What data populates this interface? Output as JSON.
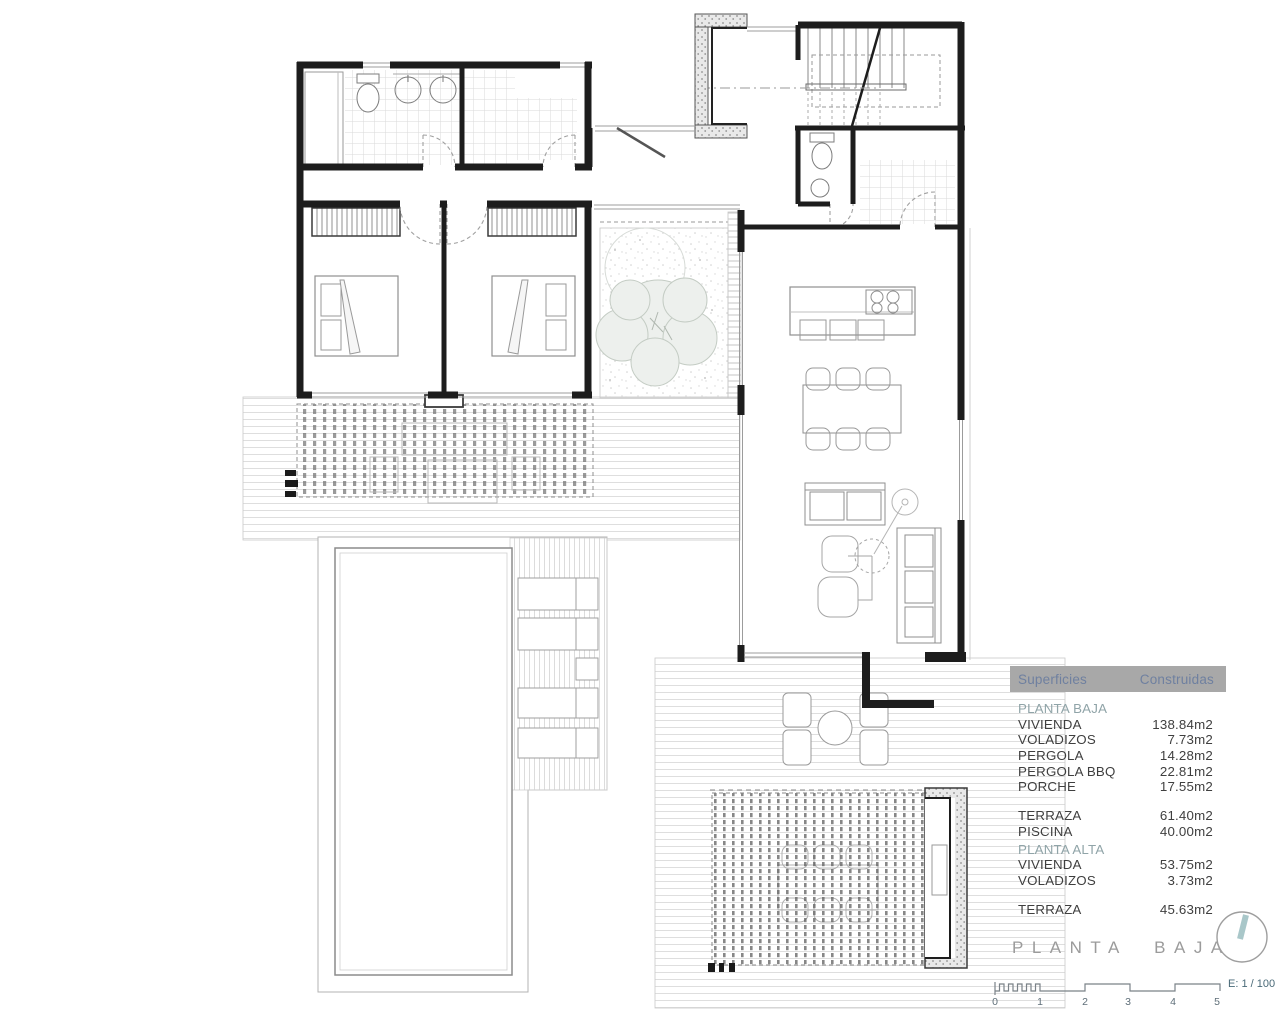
{
  "colors": {
    "wall": "#1d1d1d",
    "furniture_line": "#9a9a9a",
    "accent_teal": "#a9c7c9",
    "table_header_bg": "#a8a8a8",
    "table_header_text": "#6f80a0",
    "section_text": "#90a4a8",
    "row_text": "#3f3f3f",
    "title_text": "#9b9b9b"
  },
  "surfaces_table": {
    "header": {
      "col1": "Superficies",
      "col2": "Construidas"
    },
    "rows": [
      {
        "label": "PLANTA BAJA"
      },
      {
        "label": "VIVIENDA",
        "value": "138.84m2"
      },
      {
        "label": "VOLADIZOS",
        "value": "7.73m2"
      },
      {
        "label": "PERGOLA",
        "value": "14.28m2"
      },
      {
        "label": "PERGOLA BBQ",
        "value": "22.81m2"
      },
      {
        "label": "PORCHE",
        "value": "17.55m2"
      },
      {
        "label": "TERRAZA",
        "value": "61.40m2"
      },
      {
        "label": "PISCINA",
        "value": "40.00m2"
      },
      {
        "label": "PLANTA ALTA"
      },
      {
        "label": "VIVIENDA",
        "value": "53.75m2"
      },
      {
        "label": "VOLADIZOS",
        "value": "3.73m2"
      },
      {
        "label": "TERRAZA",
        "value": "45.63m2"
      }
    ]
  },
  "title_block": {
    "title": "PLANTA BAJA",
    "scale_label": "E: 1 / 100",
    "scale_ticks": [
      "0",
      "1",
      "2",
      "3",
      "4",
      "5"
    ]
  }
}
